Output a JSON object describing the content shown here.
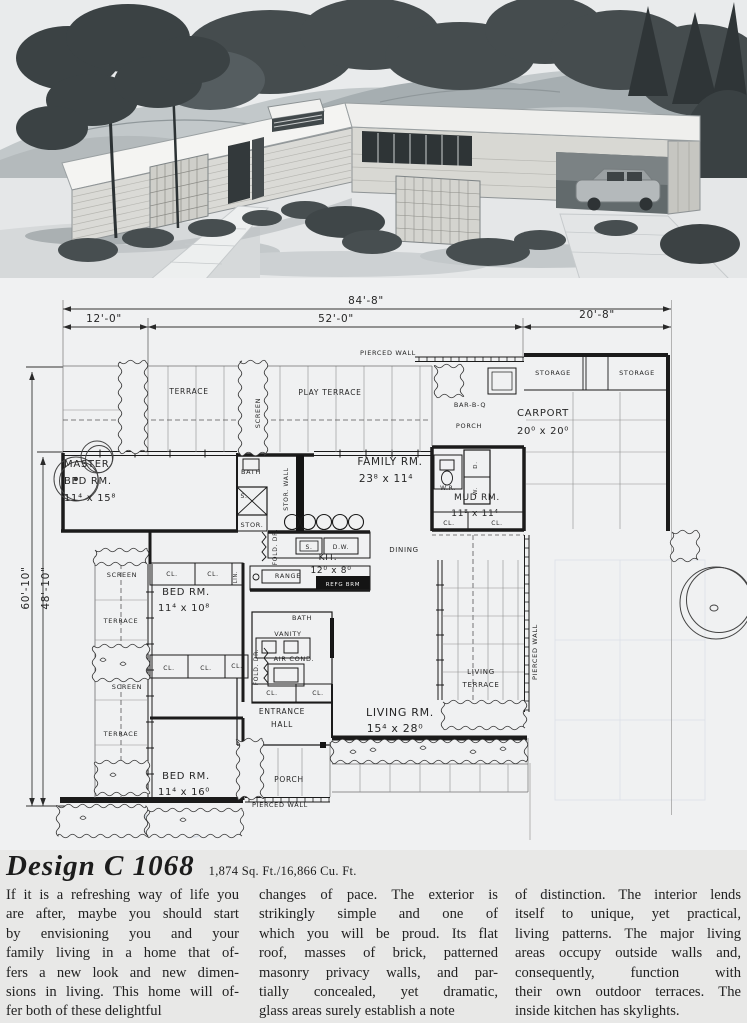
{
  "title": {
    "name": "Design C 1068",
    "stats": "1,874 Sq. Ft./16,866 Cu. Ft."
  },
  "body": {
    "columns": [
      {
        "lines": [
          "If it is a refreshing way of life you",
          "are after, maybe you should start",
          "by envisioning you and your",
          "family living in a home that of-",
          "fers a new look and new dimen-",
          "sions in living. This home will of-",
          "fer both of these delightful"
        ]
      },
      {
        "lines": [
          "changes of pace. The exterior is",
          "strikingly simple and one of",
          "which you will be proud. Its flat",
          "roof, masses of brick, patterned",
          "masonry privacy walls, and par-",
          "tially concealed, yet dramatic,",
          "glass areas surely establish a note"
        ]
      },
      {
        "lines": [
          "of distinction. The interior lends",
          "itself to unique, yet practical,",
          "living patterns. The major living",
          "areas occupy outside walls and,",
          "consequently, function with",
          "their own outdoor terraces. The",
          "inside kitchen has skylights."
        ]
      }
    ]
  },
  "plan": {
    "dimensions": {
      "overall_width": "84'-8\"",
      "left_section": "12'-0\"",
      "center_section": "52'-0\"",
      "right_section": "20'-8\"",
      "outer_depth": "60'-10\"",
      "inner_depth": "48'-10\""
    },
    "ghost_text": "Design",
    "labels": [
      {
        "t": "84'-8\"",
        "x": 366,
        "y": 304,
        "fs": 10.5
      },
      {
        "t": "12'-0\"",
        "x": 104,
        "y": 322,
        "fs": 10.5
      },
      {
        "t": "52'-0\"",
        "x": 336,
        "y": 322,
        "fs": 10.5
      },
      {
        "t": "20'-8\"",
        "x": 597,
        "y": 318,
        "fs": 10.5
      },
      {
        "t": "60'-10\"",
        "x": 29,
        "y": 588,
        "fs": 10.5,
        "rot": -90
      },
      {
        "t": "48'-10\"",
        "x": 49,
        "y": 588,
        "fs": 10.5,
        "rot": -90
      },
      {
        "t": "PIERCED  WALL",
        "x": 388,
        "y": 355,
        "fs": 6.5
      },
      {
        "t": "STORAGE",
        "x": 553,
        "y": 375,
        "fs": 6.5
      },
      {
        "t": "STORAGE",
        "x": 637,
        "y": 375,
        "fs": 6.5
      },
      {
        "t": "TERRACE",
        "x": 189,
        "y": 394,
        "fs": 7.5
      },
      {
        "t": "PLAY  TERRACE",
        "x": 330,
        "y": 395,
        "fs": 7.5
      },
      {
        "t": "SCREEN",
        "x": 260,
        "y": 413,
        "fs": 6.5,
        "rot": -90
      },
      {
        "t": "BAR-B-Q",
        "x": 470,
        "y": 407,
        "fs": 6.5
      },
      {
        "t": "PORCH",
        "x": 469,
        "y": 428,
        "fs": 6.5
      },
      {
        "t": "CARPORT",
        "x": 543,
        "y": 416,
        "fs": 10
      },
      {
        "t": "20⁰ x 20⁰",
        "x": 543,
        "y": 434,
        "fs": 10
      },
      {
        "t": "MASTER",
        "x": 64,
        "y": 467,
        "fs": 10,
        "a": "start"
      },
      {
        "t": "BED  RM.",
        "x": 64,
        "y": 484,
        "fs": 10,
        "a": "start"
      },
      {
        "t": "11⁴ x 15⁸",
        "x": 64,
        "y": 501,
        "fs": 10,
        "a": "start"
      },
      {
        "t": "BATH",
        "x": 251,
        "y": 474,
        "fs": 6.5
      },
      {
        "t": "STOR.  WALL",
        "x": 288,
        "y": 489,
        "fs": 6,
        "rot": -90
      },
      {
        "t": "FAMILY  RM.",
        "x": 390,
        "y": 465,
        "fs": 10.5
      },
      {
        "t": "23⁸ x 11⁴",
        "x": 386,
        "y": 482,
        "fs": 10.5
      },
      {
        "t": "W.R.",
        "x": 448,
        "y": 490,
        "fs": 6
      },
      {
        "t": "D.",
        "x": 477,
        "y": 465,
        "fs": 5.5,
        "rot": -90
      },
      {
        "t": "W.",
        "x": 477,
        "y": 491,
        "fs": 5.5,
        "rot": -90
      },
      {
        "t": "MUD  RM.",
        "x": 477,
        "y": 500,
        "fs": 9
      },
      {
        "t": "11⁸ x 11⁴",
        "x": 475,
        "y": 516,
        "fs": 9
      },
      {
        "t": "CL.",
        "x": 449,
        "y": 525,
        "fs": 6
      },
      {
        "t": "CL.",
        "x": 497,
        "y": 525,
        "fs": 6
      },
      {
        "t": "S.",
        "x": 244,
        "y": 498,
        "fs": 6
      },
      {
        "t": "STOR.",
        "x": 252,
        "y": 527,
        "fs": 6.5
      },
      {
        "t": "FOLD.  DR.",
        "x": 277,
        "y": 547,
        "fs": 6,
        "rot": -90
      },
      {
        "t": "S.",
        "x": 309,
        "y": 549,
        "fs": 6
      },
      {
        "t": "D.W.",
        "x": 341,
        "y": 549,
        "fs": 6
      },
      {
        "t": "KIT.",
        "x": 328,
        "y": 560,
        "fs": 9
      },
      {
        "t": "12⁰ x 8⁰",
        "x": 331,
        "y": 573,
        "fs": 9
      },
      {
        "t": "RANGE",
        "x": 288,
        "y": 578,
        "fs": 6.5
      },
      {
        "t": "REFG  BRM",
        "x": 343,
        "y": 586,
        "fs": 5.5,
        "fill": "#f2f2f2"
      },
      {
        "t": "DINING",
        "x": 404,
        "y": 552,
        "fs": 7
      },
      {
        "t": "SCREEN",
        "x": 122,
        "y": 577,
        "fs": 6.5
      },
      {
        "t": "CL.",
        "x": 172,
        "y": 576,
        "fs": 6
      },
      {
        "t": "CL.",
        "x": 213,
        "y": 576,
        "fs": 6
      },
      {
        "t": "LIN.",
        "x": 237,
        "y": 577,
        "fs": 5,
        "rot": -90
      },
      {
        "t": "BED  RM.",
        "x": 186,
        "y": 595,
        "fs": 10
      },
      {
        "t": "11⁴ x 10⁸",
        "x": 184,
        "y": 611,
        "fs": 10
      },
      {
        "t": "TERRACE",
        "x": 121,
        "y": 623,
        "fs": 6.5
      },
      {
        "t": "SCREEN",
        "x": 127,
        "y": 689,
        "fs": 6.5
      },
      {
        "t": "CL.",
        "x": 169,
        "y": 670,
        "fs": 6
      },
      {
        "t": "CL.",
        "x": 206,
        "y": 670,
        "fs": 6
      },
      {
        "t": "CL.",
        "x": 237,
        "y": 668,
        "fs": 6
      },
      {
        "t": "TERRACE",
        "x": 121,
        "y": 736,
        "fs": 6.5
      },
      {
        "t": "BATH",
        "x": 302,
        "y": 620,
        "fs": 6.5
      },
      {
        "t": "VANITY",
        "x": 288,
        "y": 636,
        "fs": 6.5
      },
      {
        "t": "AIR  COND.",
        "x": 294,
        "y": 661,
        "fs": 6.5
      },
      {
        "t": "FOLD. DR.",
        "x": 258,
        "y": 667,
        "fs": 6,
        "rot": -90
      },
      {
        "t": "CL.",
        "x": 272,
        "y": 695,
        "fs": 6
      },
      {
        "t": "CL.",
        "x": 318,
        "y": 695,
        "fs": 6
      },
      {
        "t": "ENTRANCE",
        "x": 282,
        "y": 714,
        "fs": 7.5
      },
      {
        "t": "HALL",
        "x": 282,
        "y": 727,
        "fs": 7.5
      },
      {
        "t": "LIVING  RM.",
        "x": 400,
        "y": 716,
        "fs": 11
      },
      {
        "t": "15⁴ x 28⁰",
        "x": 395,
        "y": 732,
        "fs": 11
      },
      {
        "t": "LIVING",
        "x": 481,
        "y": 674,
        "fs": 7
      },
      {
        "t": "TERRACE",
        "x": 481,
        "y": 687,
        "fs": 7
      },
      {
        "t": "PIERCED  WALL",
        "x": 537,
        "y": 652,
        "fs": 6.5,
        "rot": -90
      },
      {
        "t": "PORCH",
        "x": 289,
        "y": 782,
        "fs": 7.5
      },
      {
        "t": "PIERCED  WALL",
        "x": 280,
        "y": 807,
        "fs": 6.5
      },
      {
        "t": "BED  RM.",
        "x": 186,
        "y": 779,
        "fs": 10
      },
      {
        "t": "11⁴ x 16⁰",
        "x": 184,
        "y": 795,
        "fs": 10
      }
    ]
  }
}
